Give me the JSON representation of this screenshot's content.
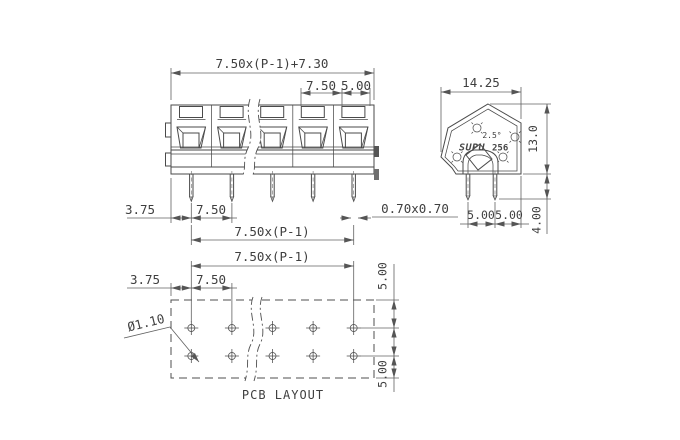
{
  "front": {
    "total": "7.50x(P-1)+7.30",
    "pitch_top": "7.50",
    "end_top": "5.00",
    "offset": "3.75",
    "pitch": "7.50",
    "pin_square": "0.70x0.70",
    "span": "7.50x(P-1)"
  },
  "side": {
    "width": "14.25",
    "height": "13.0",
    "pin_length": "4.00",
    "spacing_a": "5.00",
    "spacing_b": "5.00",
    "angle": "2.5°",
    "brand": "SUPU",
    "model": "256"
  },
  "pcb": {
    "span": "7.50x(P-1)",
    "offset": "3.75",
    "pitch": "7.50",
    "hole_dia": "Ø1.10",
    "row_top": "5.00",
    "row_bottom": "5.00",
    "title": "PCB LAYOUT"
  },
  "colors": {
    "line": "#4a4a4a",
    "dim": "#606060",
    "background": "#ffffff"
  }
}
